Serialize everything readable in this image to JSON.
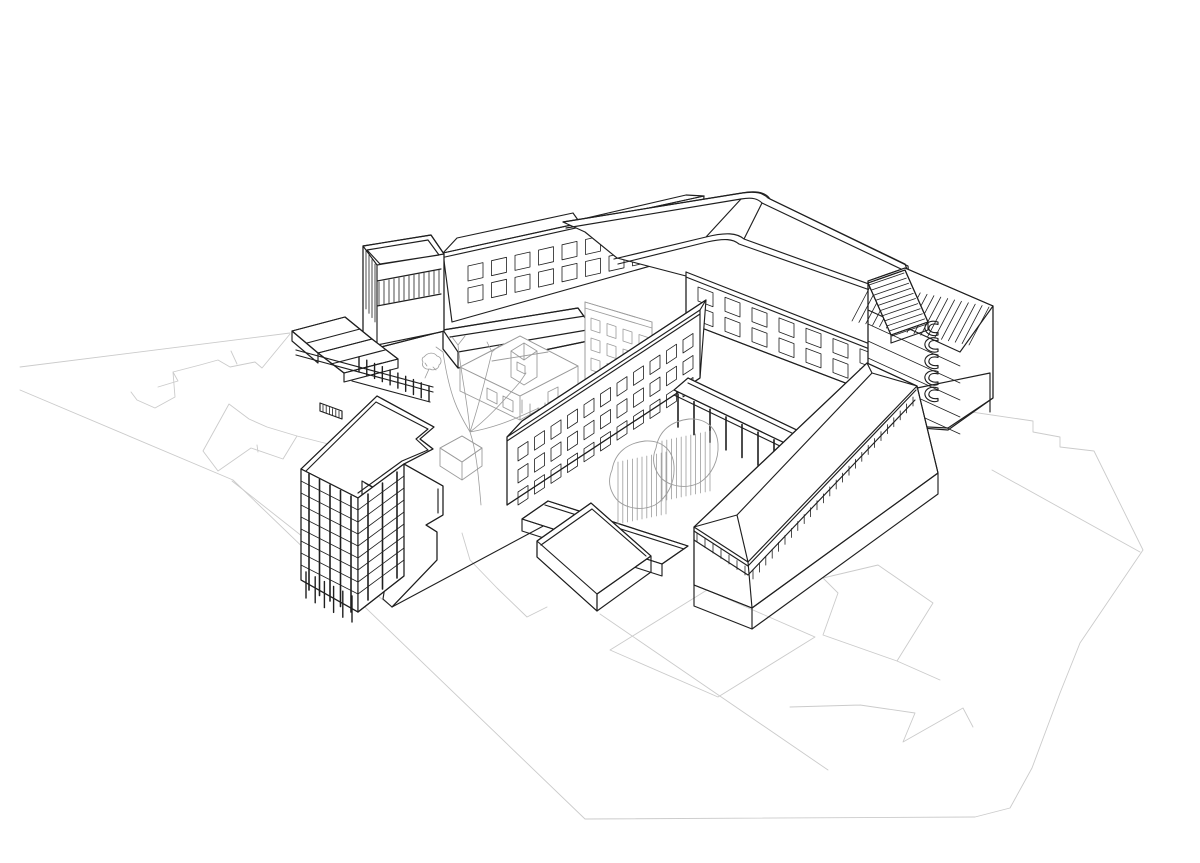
{
  "canvas": {
    "width": 1200,
    "height": 863,
    "background": "#ffffff"
  },
  "palette": {
    "paper": "#ffffff",
    "primary": "#1f1f1f",
    "secondary": "#9c9c9c",
    "context": "#cbcbcb"
  },
  "drawing": {
    "kind": "architectural-axonometric-line-drawing",
    "components": [
      "site-context-footprints",
      "north-wing",
      "curved-corner-building",
      "balcony-tower",
      "southeast-wing",
      "central-wing",
      "glazed-tower",
      "street-block",
      "courtyard-canopy",
      "colonnade",
      "terraces",
      "courtyard-trees",
      "historic-courtyard-buildings"
    ]
  },
  "balcony_d": "M0 0 c -9 -3 -14 3 -13 7 c 1 5 8 8 13 6 l 0 -2.5 c -6 1 -10 -2 -9 -5 c 1 -4 6 -4 9 -3 z",
  "procedural": [
    {
      "group": "gen-windows-a",
      "type": "windows",
      "origin": [
        468,
        266
      ],
      "colStep": [
        23.5,
        -5.3
      ],
      "rowStep": [
        0,
        22
      ],
      "cols": 10,
      "rows": 2,
      "w": [
        15,
        -3.4
      ],
      "h": [
        0,
        15
      ]
    },
    {
      "group": "gen-windows-b",
      "type": "windows",
      "origin": [
        698,
        287
      ],
      "colStep": [
        27,
        10.3
      ],
      "rowStep": [
        0,
        20
      ],
      "cols": 8,
      "rows": 2,
      "w": [
        15,
        5.7
      ],
      "h": [
        0,
        14
      ]
    },
    {
      "group": "gen-windows-f",
      "type": "windows",
      "origin": [
        518,
        448
      ],
      "colStep": [
        16.5,
        -10.8
      ],
      "rowStep": [
        0,
        22
      ],
      "cols": 11,
      "rows": 3,
      "w": [
        10,
        -6.6
      ],
      "h": [
        0,
        13
      ]
    },
    {
      "group": "gen-windows-gray",
      "type": "windows",
      "origin": [
        591,
        318
      ],
      "colStep": [
        16,
        5.5
      ],
      "rowStep": [
        0,
        20
      ],
      "cols": 4,
      "rows": 3,
      "w": [
        9,
        3
      ],
      "h": [
        0,
        12
      ]
    },
    {
      "group": "gen-ribs-annex",
      "type": "fence",
      "from": [
        869,
        285
      ],
      "to": [
        892,
        336
      ],
      "count": 11,
      "dir": [
        35,
        -12
      ]
    },
    {
      "group": "gen-ribs-main",
      "type": "fence",
      "from": [
        872,
        283
      ],
      "to": [
        989,
        307
      ],
      "count": 18,
      "dir": [
        -20,
        38
      ]
    },
    {
      "group": "gen-rails-c",
      "type": "rails",
      "from": [
        868,
        324
      ],
      "to": [
        960,
        366
      ],
      "count": 5,
      "step": [
        0,
        17
      ]
    },
    {
      "group": "gen-balconies",
      "type": "balcony",
      "origin": [
        938,
        322
      ],
      "step": [
        0,
        16.5
      ],
      "count": 5
    },
    {
      "group": "gen-band-d-end",
      "type": "fence",
      "from": [
        697,
        533
      ],
      "to": [
        745,
        566
      ],
      "count": 7,
      "dir": [
        0,
        9
      ]
    },
    {
      "group": "gen-band-d-front",
      "type": "fence",
      "from": [
        753,
        570
      ],
      "to": [
        913,
        397
      ],
      "count": 26,
      "dir": [
        0,
        9
      ]
    },
    {
      "group": "gen-mullions-h",
      "type": "fence",
      "from": [
        379,
        282
      ],
      "to": [
        439,
        270
      ],
      "count": 13,
      "dir": [
        0,
        23
      ]
    },
    {
      "group": "gen-glazing-h-left",
      "type": "fence",
      "from": [
        366,
        251
      ],
      "to": [
        375,
        264
      ],
      "count": 4,
      "dir": [
        0,
        58
      ]
    },
    {
      "group": "gen-cols-e",
      "type": "fence",
      "from": [
        678,
        394
      ],
      "to": [
        806,
        455
      ],
      "count": 9,
      "dir": [
        0,
        33
      ],
      "w": 1.6
    },
    {
      "group": "gen-cols-i",
      "type": "fence",
      "from": [
        359,
        357
      ],
      "to": [
        429,
        386
      ],
      "count": 10,
      "dir": [
        0,
        15
      ],
      "w": 1.4
    },
    {
      "group": "gen-hatch-stair",
      "type": "fence",
      "from": [
        323,
        405
      ],
      "to": [
        339,
        411
      ],
      "count": 6,
      "dir": [
        0,
        7
      ]
    },
    {
      "group": "gen-pilasters-j",
      "type": "fence",
      "from": [
        309,
        474
      ],
      "to": [
        351,
        496
      ],
      "count": 5,
      "dir": [
        0,
        116
      ],
      "w": 1.6
    },
    {
      "group": "gen-pilasters-j2",
      "type": "fence",
      "from": [
        368,
        494
      ],
      "to": [
        397,
        472
      ],
      "count": 3,
      "dir": [
        0,
        106
      ],
      "w": 1.6
    },
    {
      "group": "gen-rails-j",
      "type": "rails",
      "from": [
        301,
        481
      ],
      "to": [
        358,
        510
      ],
      "count": 8,
      "step": [
        0,
        12
      ]
    },
    {
      "group": "gen-rails-j2",
      "type": "rails",
      "from": [
        358,
        510
      ],
      "to": [
        404,
        476
      ],
      "count": 8,
      "step": [
        0,
        12
      ]
    },
    {
      "group": "gen-gcols-j",
      "type": "fence",
      "from": [
        306,
        572
      ],
      "to": [
        352,
        596
      ],
      "count": 6,
      "dir": [
        0,
        26
      ],
      "w": 1.4
    },
    {
      "group": "gen-streaks-t1",
      "type": "fence",
      "from": [
        618,
        462
      ],
      "to": [
        666,
        452
      ],
      "count": 11,
      "dir": [
        0,
        62
      ]
    },
    {
      "group": "gen-streaks-t2",
      "type": "fence",
      "from": [
        662,
        441
      ],
      "to": [
        710,
        431
      ],
      "count": 11,
      "dir": [
        0,
        60
      ]
    }
  ]
}
